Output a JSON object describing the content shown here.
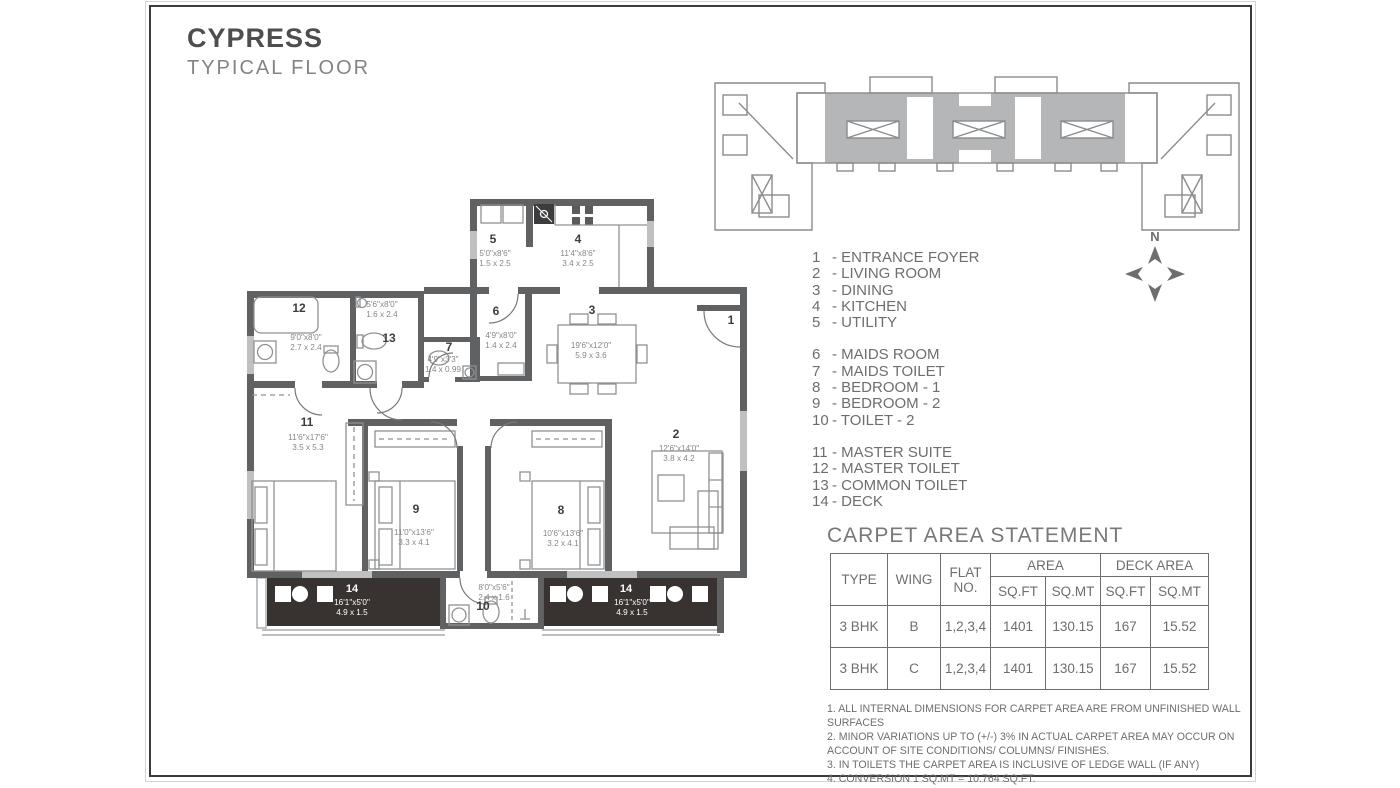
{
  "title": "CYPRESS",
  "subtitle": "TYPICAL FLOOR",
  "north_label": "N",
  "legend": {
    "groups": [
      [
        {
          "num": "1",
          "label": "ENTRANCE FOYER"
        },
        {
          "num": "2",
          "label": "LIVING ROOM"
        },
        {
          "num": "3",
          "label": "DINING"
        },
        {
          "num": "4",
          "label": "KITCHEN"
        },
        {
          "num": "5",
          "label": "UTILITY"
        }
      ],
      [
        {
          "num": "6",
          "label": "MAIDS ROOM"
        },
        {
          "num": "7",
          "label": "MAIDS TOILET"
        },
        {
          "num": "8",
          "label": "BEDROOM - 1"
        },
        {
          "num": "9",
          "label": "BEDROOM - 2"
        },
        {
          "num": "10",
          "label": "TOILET - 2"
        }
      ],
      [
        {
          "num": "11",
          "label": "MASTER SUITE"
        },
        {
          "num": "12",
          "label": "MASTER TOILET"
        },
        {
          "num": "13",
          "label": "COMMON TOILET"
        },
        {
          "num": "14",
          "label": "DECK"
        }
      ]
    ]
  },
  "carpet_table": {
    "title": "CARPET AREA STATEMENT",
    "headers": {
      "type": "TYPE",
      "wing": "WING",
      "flat": "FLAT NO.",
      "area": "AREA",
      "deck_area": "DECK AREA",
      "sqft": "SQ.FT",
      "sqmt": "SQ.MT"
    },
    "rows": [
      {
        "type": "3 BHK",
        "wing": "B",
        "flat": "1,2,3,4",
        "area_sqft": "1401",
        "area_sqmt": "130.15",
        "deck_sqft": "167",
        "deck_sqmt": "15.52"
      },
      {
        "type": "3 BHK",
        "wing": "C",
        "flat": "1,2,3,4",
        "area_sqft": "1401",
        "area_sqmt": "130.15",
        "deck_sqft": "167",
        "deck_sqmt": "15.52"
      }
    ]
  },
  "notes": [
    "1.  ALL INTERNAL DIMENSIONS FOR CARPET AREA ARE FROM UNFINISHED WALL SURFACES",
    "2. MINOR VARIATIONS UP TO (+/-) 3% IN ACTUAL CARPET AREA MAY OCCUR ON  ACCOUNT OF SITE CONDITIONS/ COLUMNS/ FINISHES.",
    "3. IN TOILETS THE CARPET AREA IS INCLUSIVE OF LEDGE WALL   (IF ANY)",
    "4. CONVERSION 1 SQ.MT = 10.764 SQ.FT."
  ],
  "floor_plan": {
    "rooms": [
      {
        "key": "1",
        "num": "1",
        "ft": "",
        "m": ""
      },
      {
        "key": "2",
        "num": "2",
        "ft": "12'6\"x14'0\"",
        "m": "3.8 x 4.2"
      },
      {
        "key": "3",
        "num": "3",
        "ft": "19'6\"x12'0\"",
        "m": "5.9 x 3.6"
      },
      {
        "key": "4",
        "num": "4",
        "ft": "11'4\"x8'6\"",
        "m": "3.4 x 2.5"
      },
      {
        "key": "5",
        "num": "5",
        "ft": "5'0\"x8'6\"",
        "m": "1.5 x 2.5"
      },
      {
        "key": "6",
        "num": "6",
        "ft": "4'9\"x8'0\"",
        "m": "1.4 x 2.4"
      },
      {
        "key": "7",
        "num": "7",
        "ft": "4'9\"x3'3\"",
        "m": "1.4 x 0.99"
      },
      {
        "key": "8",
        "num": "8",
        "ft": "10'6\"x13'6\"",
        "m": "3.2 x 4.1"
      },
      {
        "key": "9",
        "num": "9",
        "ft": "11'0\"x13'6\"",
        "m": "3.3 x 4.1"
      },
      {
        "key": "10",
        "num": "10",
        "ft": "8'0\"x5'6\"",
        "m": "2.4 x 1.6"
      },
      {
        "key": "11",
        "num": "11",
        "ft": "11'6\"x17'6\"",
        "m": "3.5 x 5.3"
      },
      {
        "key": "12",
        "num": "12",
        "ft": "9'0\"x8'0\"",
        "m": "2.7 x 2.4"
      },
      {
        "key": "13",
        "num": "13",
        "ft": "5'6\"x8'0\"",
        "m": "1.6 x 2.4"
      },
      {
        "key": "14L",
        "num": "14",
        "ft": "16'1\"x5'0\"",
        "m": "4.9 x 1.5"
      },
      {
        "key": "14R",
        "num": "14",
        "ft": "16'1\"x5'0\"",
        "m": "4.9 x 1.5"
      }
    ]
  },
  "colors": {
    "wall": "#606163",
    "deck_fill": "#383230",
    "text_gray": "#6d6e70",
    "shaded_units": "#b4b6b8"
  }
}
